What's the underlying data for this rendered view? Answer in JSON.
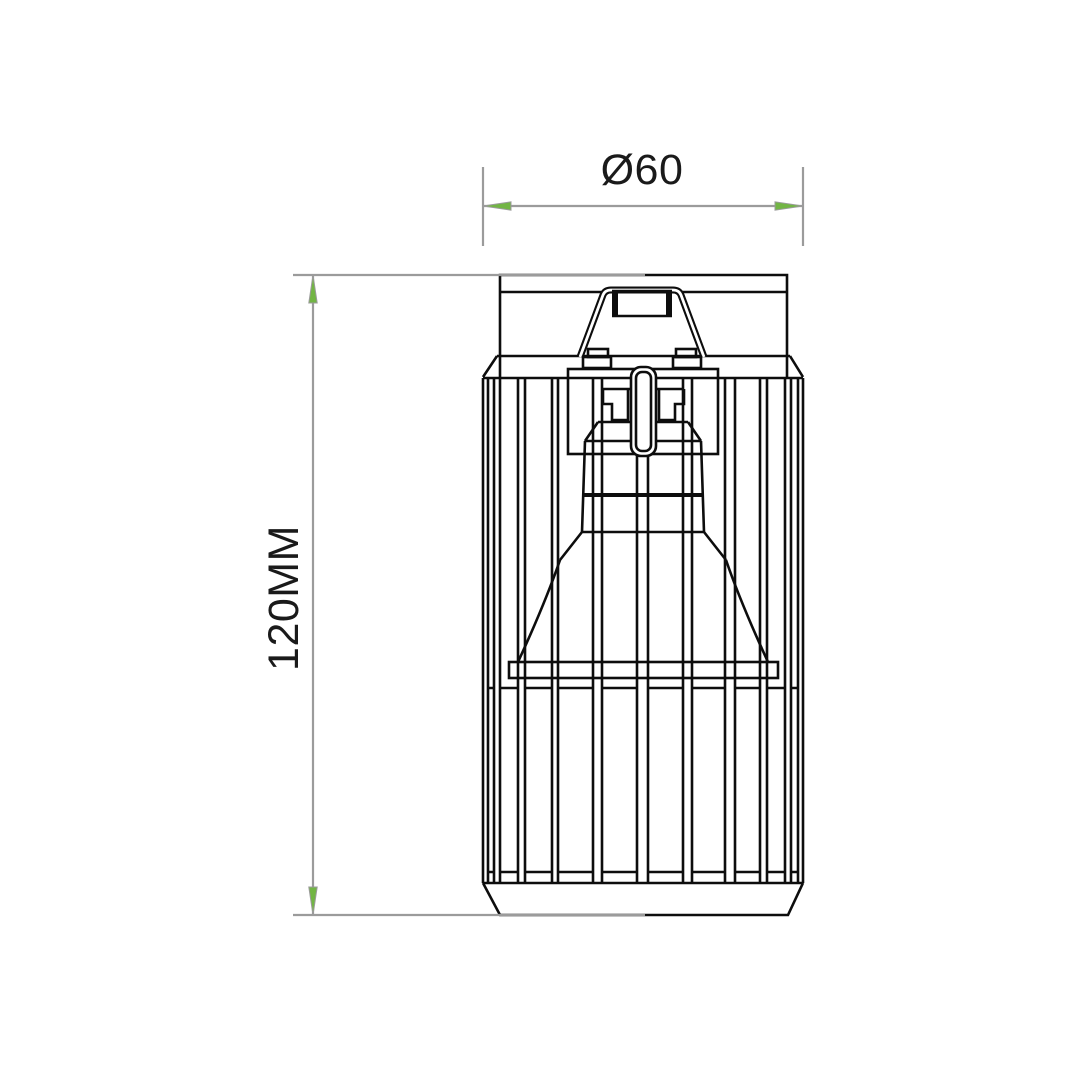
{
  "page": {
    "background": "#ffffff"
  },
  "drawing": {
    "type": "technical-line-drawing",
    "subject": "ceiling-spotlight-wire-cage-front-elevation",
    "dimensions": {
      "width": {
        "label": "Ø60",
        "orientation": "horizontal"
      },
      "height": {
        "label": "120MM",
        "orientation": "vertical"
      }
    },
    "colors": {
      "ink": "#0d0d0d",
      "dimension_line": "#9b9b9b",
      "arrow_fill": "#72b544",
      "label_text": "#1a1a1a",
      "background": "#ffffff"
    }
  }
}
